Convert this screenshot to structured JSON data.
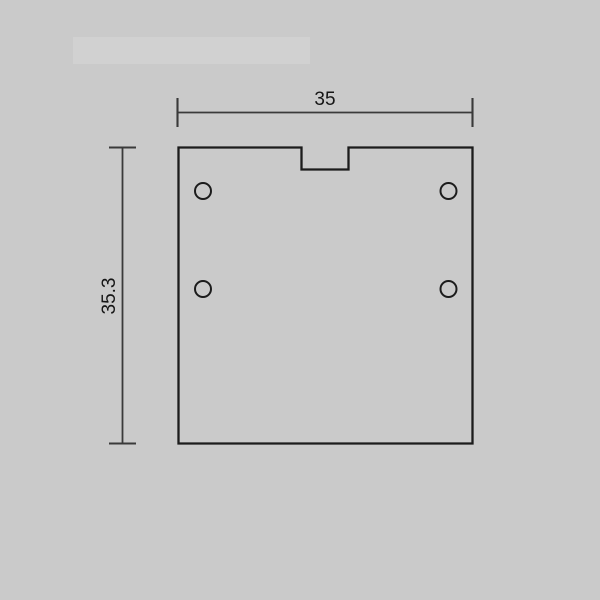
{
  "colors": {
    "background": "#cacaca",
    "outline": "#1c1c1c",
    "dimension": "#3a3a3a",
    "label": "#161616"
  },
  "drawing": {
    "type": "2d-technical-drawing",
    "shape": "square-plate-with-top-center-notch",
    "hole_count": 4,
    "dimensions": {
      "width_label": "35",
      "height_label": "35.3"
    }
  }
}
